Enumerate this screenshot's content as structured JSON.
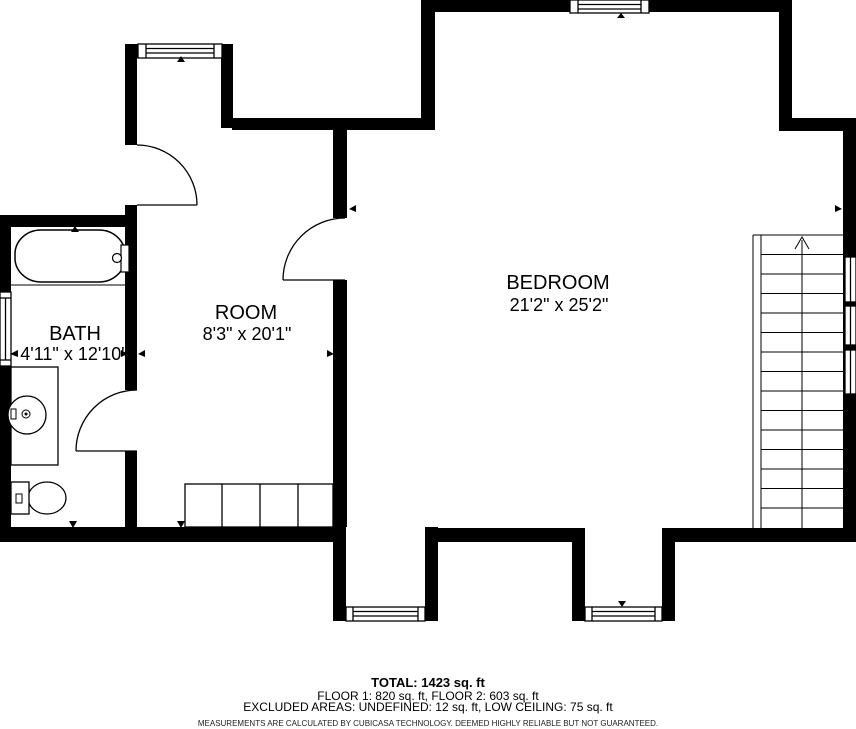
{
  "floorplan": {
    "rooms": [
      {
        "name": "BATH",
        "dimensions": "4'11\" x 12'10\""
      },
      {
        "name": "ROOM",
        "dimensions": "8'3\" x 20'1\""
      },
      {
        "name": "BEDROOM",
        "dimensions": "21'2\" x 25'2\""
      }
    ],
    "summary": {
      "total": "TOTAL: 1423 sq. ft",
      "floors": "FLOOR 1: 820 sq. ft, FLOOR 2: 603 sq. ft",
      "excluded": "EXCLUDED AREAS: UNDEFINED: 12 sq. ft, LOW CEILING: 75 sq. ft"
    },
    "disclaimer": "MEASUREMENTS ARE CALCULATED BY CUBICASA TECHNOLOGY. DEEMED HIGHLY RELIABLE BUT NOT GUARANTEED.",
    "colors": {
      "wall": "#000000",
      "background": "#ffffff",
      "line": "#000000",
      "text": "#000000"
    }
  }
}
